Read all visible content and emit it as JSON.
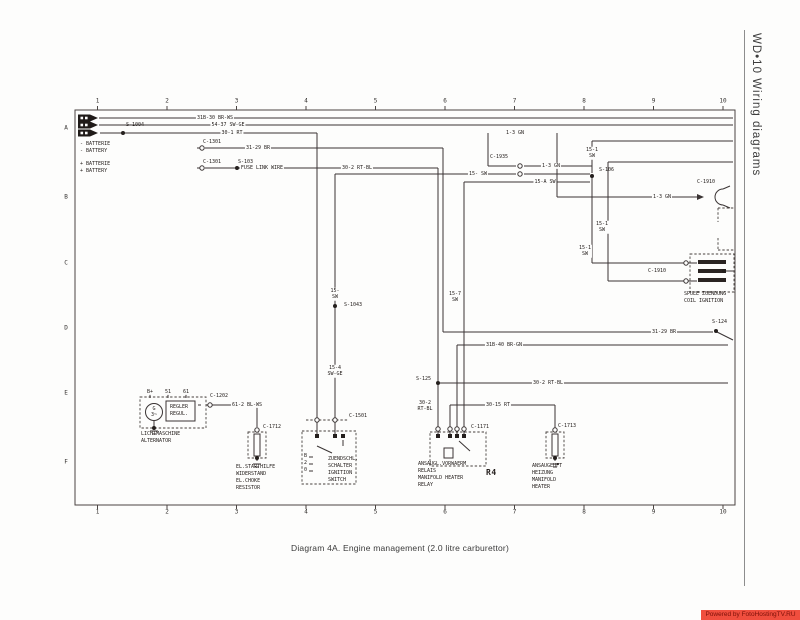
{
  "sidebar": {
    "title": "WD•10 Wiring diagrams"
  },
  "footer": {
    "caption": "Diagram 4A. Engine management (2.0 litre carburettor)",
    "watermark": "Powered by FotoHostingTV.RU"
  },
  "colors": {
    "watermark_bg": "#f04e3e",
    "watermark_text": "#7c1008",
    "line": "#3a3434"
  },
  "grid": {
    "cols": [
      "1",
      "2",
      "3",
      "4",
      "5",
      "6",
      "7",
      "8",
      "9",
      "10"
    ],
    "rows": [
      "A",
      "B",
      "C",
      "D",
      "E",
      "F"
    ]
  },
  "labels": {
    "w1": "31B-30 BR-WS",
    "w2": "54-37 SW-GE",
    "w3": "30-1 RT",
    "s1004": "S-1004",
    "batNegDe": "- BATTERIE",
    "batNegEn": "- BATTERY",
    "c1301": "C-1301",
    "w4": "31-29 BR",
    "batPosDe": "+ BATTERIE",
    "batPosEn": "+ BATTERY",
    "fuse": "FUSE LINK WIRE",
    "s103": "S-103",
    "w5": "30-2 RT-BL",
    "w6": "1-3 GN",
    "w7": "15-1\nSW",
    "c1935": "C-1935",
    "w8": "15- SW",
    "w9": "15-A SW",
    "s106": "S-106",
    "c1910": "C-1910",
    "coilDe": "SPULE ZUENDUNG",
    "coilEn": "COIL IGNITION",
    "s124": "S-124",
    "w10": "31B-40 BR-GN",
    "w11": "15-7\nSW",
    "s125": "S-125",
    "w12": "30-2\nRT-BL",
    "w13": "30-15 RT",
    "w14": "15-\nSW",
    "s1043": "S-1043",
    "w15": "15-4\nSW-GE",
    "c1202": "C-1202",
    "w16": "61-2 BL-WS",
    "altB": "B+",
    "alt51": "51",
    "alt61": "61",
    "reg1": "REGLER",
    "reg2": "REGUL.",
    "altG": "G",
    "altG2": "3~",
    "altDe": "LICHTMASCHINE",
    "altEn": "ALTERNATOR",
    "c1712": "C-1712",
    "res1": "EL.STARTHILFE",
    "res2": "WIDERSTAND",
    "res3": "EL.CHOKE",
    "res4": "RESISTOR",
    "c1501": "C-1501",
    "swB": "B",
    "sw2": "2",
    "sw0": "0",
    "swDe1": "ZUENDSCHL.",
    "swDe2": "SCHALTER",
    "swEn1": "IGNITION",
    "swEn2": "SWITCH",
    "c1171": "C-1171",
    "rel1": "ANSAUGL.VORWAERM",
    "rel2": "RELAIS",
    "rel3": "MANIFOLD HEATER",
    "rel4": "RELAY",
    "r4": "R4",
    "c1713": "C-1713",
    "ht1": "ANSAUGLUFT",
    "ht2": "HEIZUNG",
    "ht3": "MANIFOLD",
    "ht4": "HEATER"
  }
}
